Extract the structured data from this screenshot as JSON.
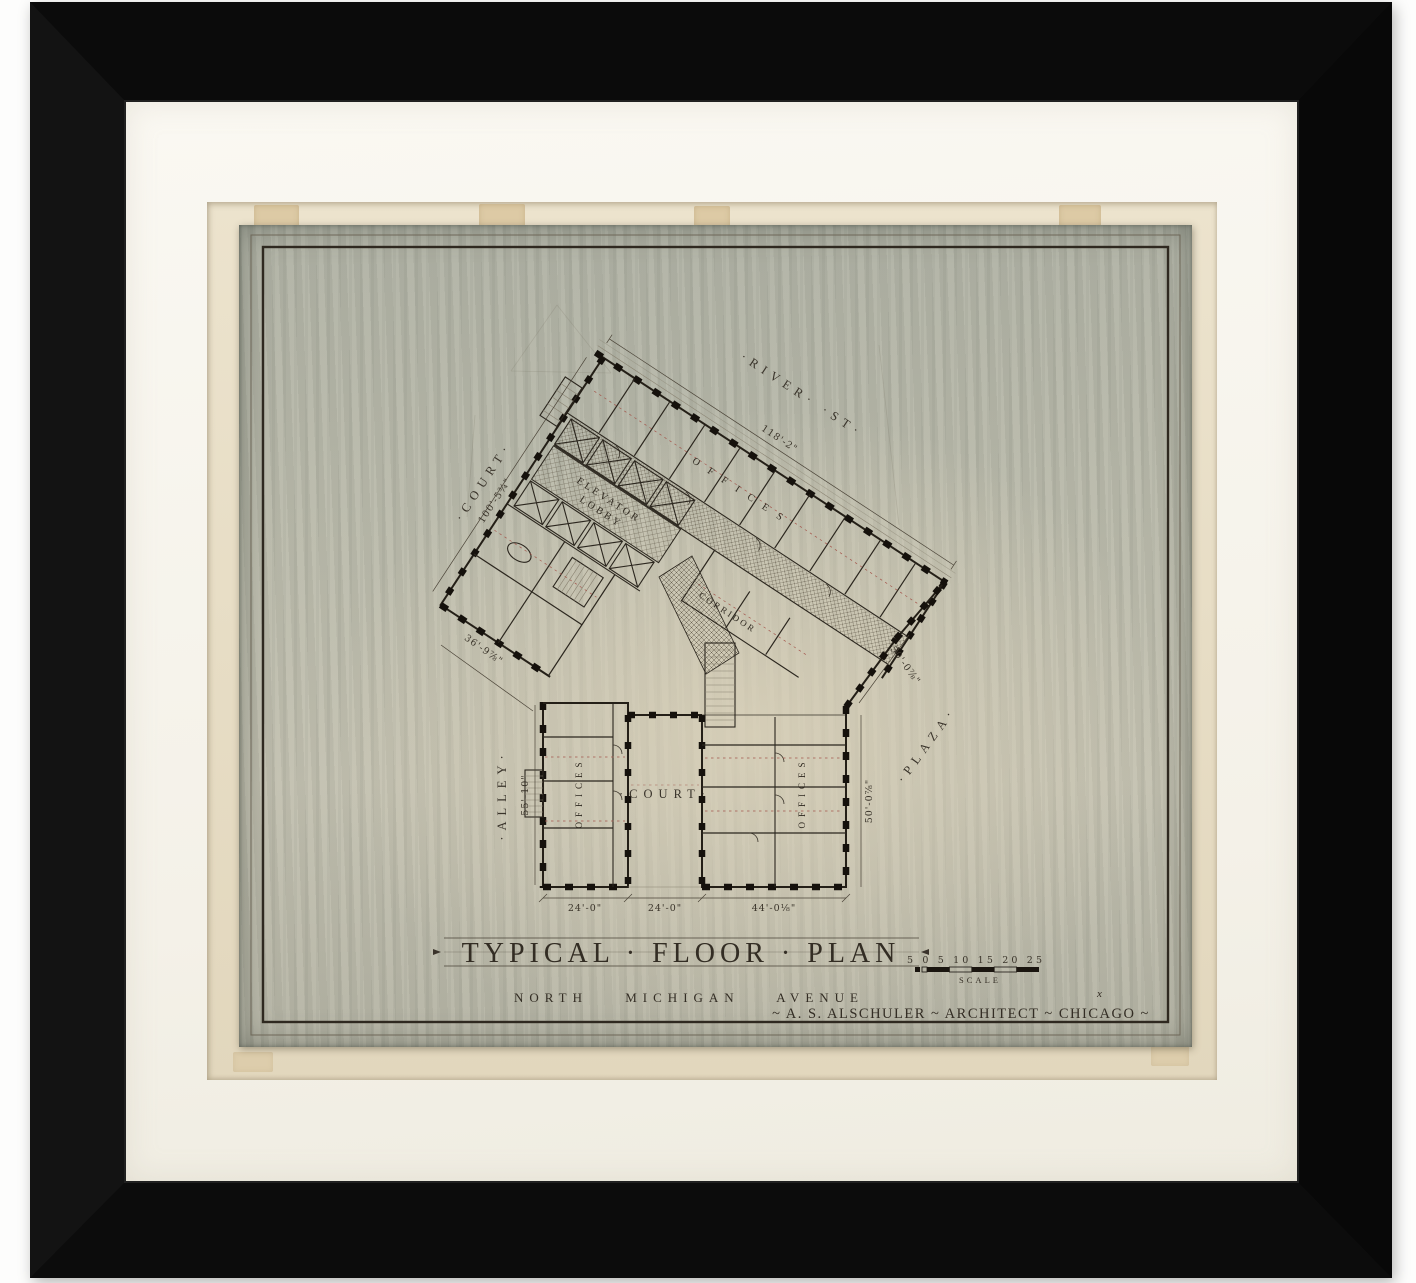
{
  "artwork": {
    "title": "TYPICAL · FLOOR · PLAN",
    "subtitle": "NORTH MICHIGAN AVENUE",
    "credit": "~ A. S. ALSCHULER ~ ARCHITECT ~ CHICAGO ~",
    "scale_label": "SCALE",
    "scale_numbers": "5 0 5 10 15 20 25",
    "x_mark": "x"
  },
  "plan": {
    "streets": {
      "river": "·RIVER·  ·ST·",
      "court_upper": "·COURT·",
      "alley": "·ALLEY·",
      "plaza": "·PLAZA·",
      "court_lower": "·COURT·"
    },
    "rooms": {
      "elevator_line1": "ELEVATOR",
      "elevator_line2": "LOBBY",
      "corridor": "CORRIDOR",
      "offices_top": "OFFICES",
      "offices_left": "OFFICES",
      "offices_right": "OFFICES"
    },
    "dims": {
      "river": "118'-2\"",
      "court": "100'-5¾\"",
      "wing_left": "36'-9⅞\"",
      "alley": "55'-10\"",
      "plaza_diag": "50'-0⅞\"",
      "plaza_side": "50'-0⅞\"",
      "bottom_left": "24'-0\"",
      "bottom_mid": "24'-0\"",
      "bottom_right": "44'-0⅛\""
    }
  },
  "colors": {
    "frame": "#0b0b0b",
    "mat": "#f8f6ef",
    "backing": "#eae0c8",
    "sheet": "#b9bbae",
    "ink": "#2b241b",
    "accent_red": "#a4574d"
  }
}
